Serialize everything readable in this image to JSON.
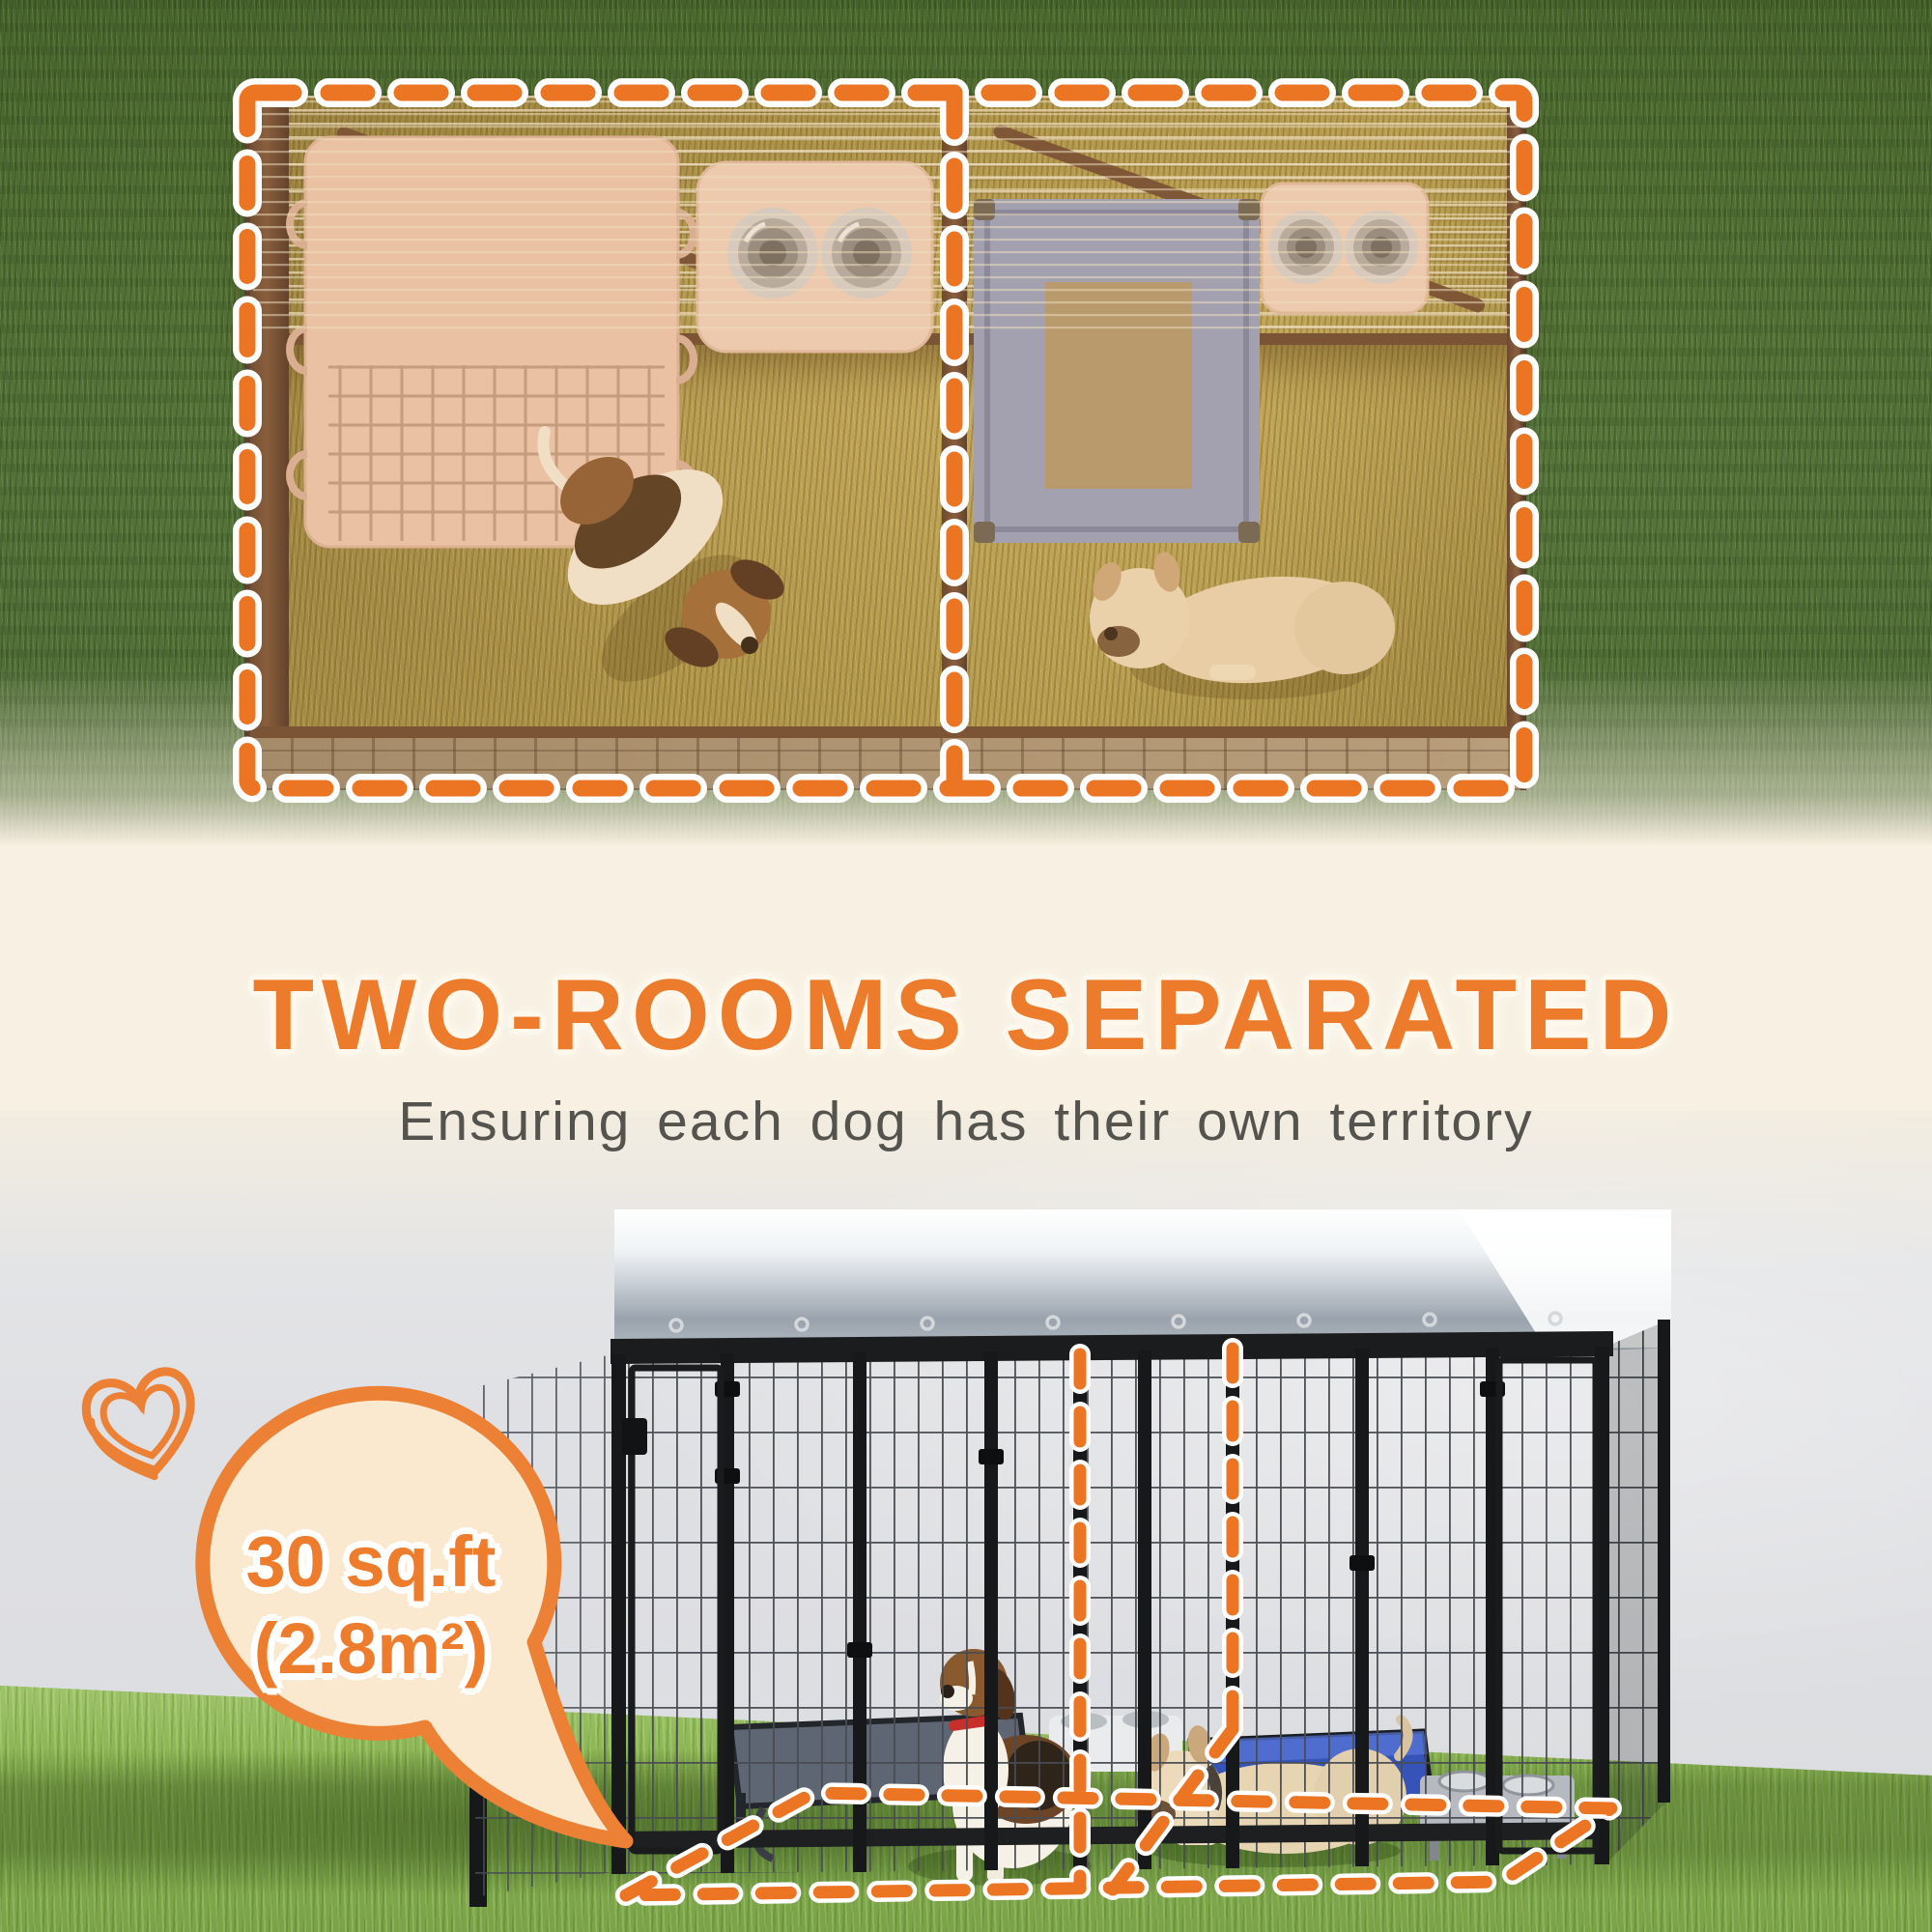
{
  "headline": {
    "title": "TWO-ROOMS SEPARATED",
    "subtitle": "Ensuring each dog has their own territory"
  },
  "size_badge": {
    "line1": "30 sq.ft",
    "line2": "(2.8m²)"
  },
  "icons": {
    "heart_doodle": "heart-doodle-icon",
    "speech_bubble": "speech-bubble",
    "dashed_room_outline": "dashed-outline",
    "dashed_floor_outline": "dashed-floor-outline"
  },
  "colors": {
    "accent_orange": "#ED7B2C",
    "dash_orange": "#EC7524",
    "cream_background": "#F8F0E2",
    "subtitle_gray": "#55534E",
    "bubble_fill": "#FAE8CF",
    "bubble_border": "#EC8135",
    "grass_top_green": "#567539",
    "grass_bottom_green": "#8AB550",
    "wall_gray": "#DFE0E3",
    "kennel_frame_black": "#17181A",
    "canopy_white": "#FFFFFF",
    "interior_amber": "#A29147",
    "left_bed_pink": "#ECC9B1",
    "right_bed_blue": "#99A3C1",
    "bed_mat_tan": "#B19B71",
    "tray_cream": "#EFD3BD",
    "bowl_silver": "#CFCDC9"
  }
}
